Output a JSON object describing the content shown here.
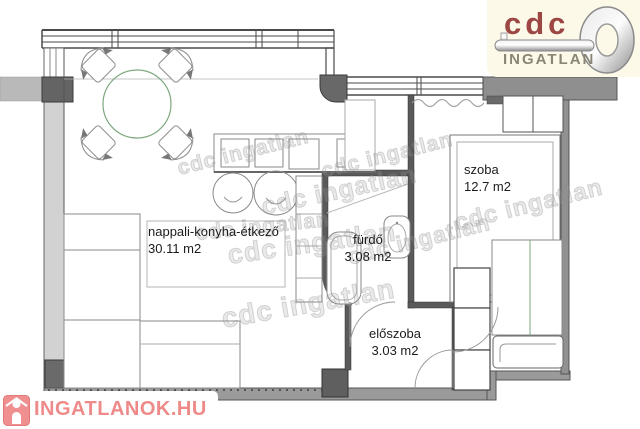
{
  "branding": {
    "cdc_logo": {
      "brand": "cdc",
      "subtitle": "INGATLAN",
      "brand_color": "#9c4743",
      "subtitle_color": "#8a8575",
      "bg_color": "#fcf9e9"
    },
    "site_logo": {
      "text": "INGATLANOK.HU",
      "color": "#ee8a8a"
    },
    "watermark_text": "cdc ingatlan"
  },
  "floor_plan": {
    "rooms": [
      {
        "key": "living",
        "name": "nappali-konyha-étkező",
        "area": "30.11 m2"
      },
      {
        "key": "bedroom",
        "name": "szoba",
        "area": "12.7 m2"
      },
      {
        "key": "bathroom",
        "name": "fürdő",
        "area": "3.08 m2"
      },
      {
        "key": "hall",
        "name": "előszoba",
        "area": "3.03 m2"
      }
    ],
    "colors": {
      "accent_green": "#7fa87f",
      "wall_light": "#d2d2d2",
      "wall_mid": "#9a9a9a",
      "wall_dark": "#5f5f5f",
      "line": "#4a4a4a"
    }
  }
}
